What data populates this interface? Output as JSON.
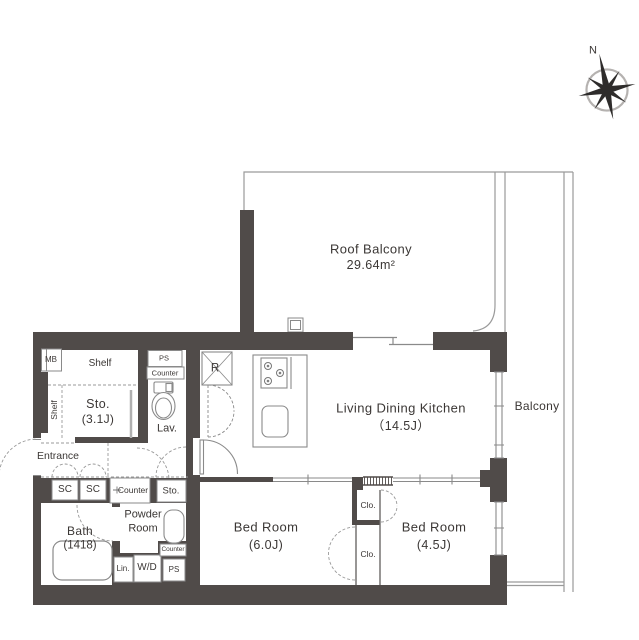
{
  "compass": {
    "north": "N"
  },
  "rooms": {
    "roof_balcony": {
      "name": "Roof Balcony",
      "area": "29.64m²"
    },
    "ldk": {
      "name": "Living Dining Kitchen",
      "area": "（14.5J）"
    },
    "balcony": {
      "name": "Balcony"
    },
    "bedroom_6j": {
      "name": "Bed Room",
      "area": "(6.0J)"
    },
    "bedroom_45j": {
      "name": "Bed Room",
      "area": "(4.5J)"
    },
    "bath": {
      "name": "Bath",
      "area": "(1418)"
    },
    "powder_room": {
      "line1": "Powder",
      "line2": "Room"
    },
    "storage": {
      "name": "Sto.",
      "area": "(3.1J)"
    },
    "entrance": {
      "name": "Entrance"
    }
  },
  "fixtures": {
    "meter_box": "MB",
    "pipe_space_top": "PS",
    "counter_top": "Counter",
    "shelf_top": "Shelf",
    "shelf_side": "Shelf",
    "lavatory": "Lav.",
    "refrigerator": "R",
    "shoe_cabinet_1": "SC",
    "shoe_cabinet_2": "SC",
    "counter_mid": "Counter",
    "storage_small": "Sto.",
    "linen": "Lin.",
    "washer_dryer": "W/D",
    "counter_small": "Counter",
    "pipe_space_bottom": "PS",
    "closet_upper": "Clo.",
    "closet_lower": "Clo."
  },
  "colors": {
    "wall": "#504b49",
    "line": "#8a8a8a",
    "balcony_line": "#9a9a9a",
    "text": "#3b3735"
  }
}
